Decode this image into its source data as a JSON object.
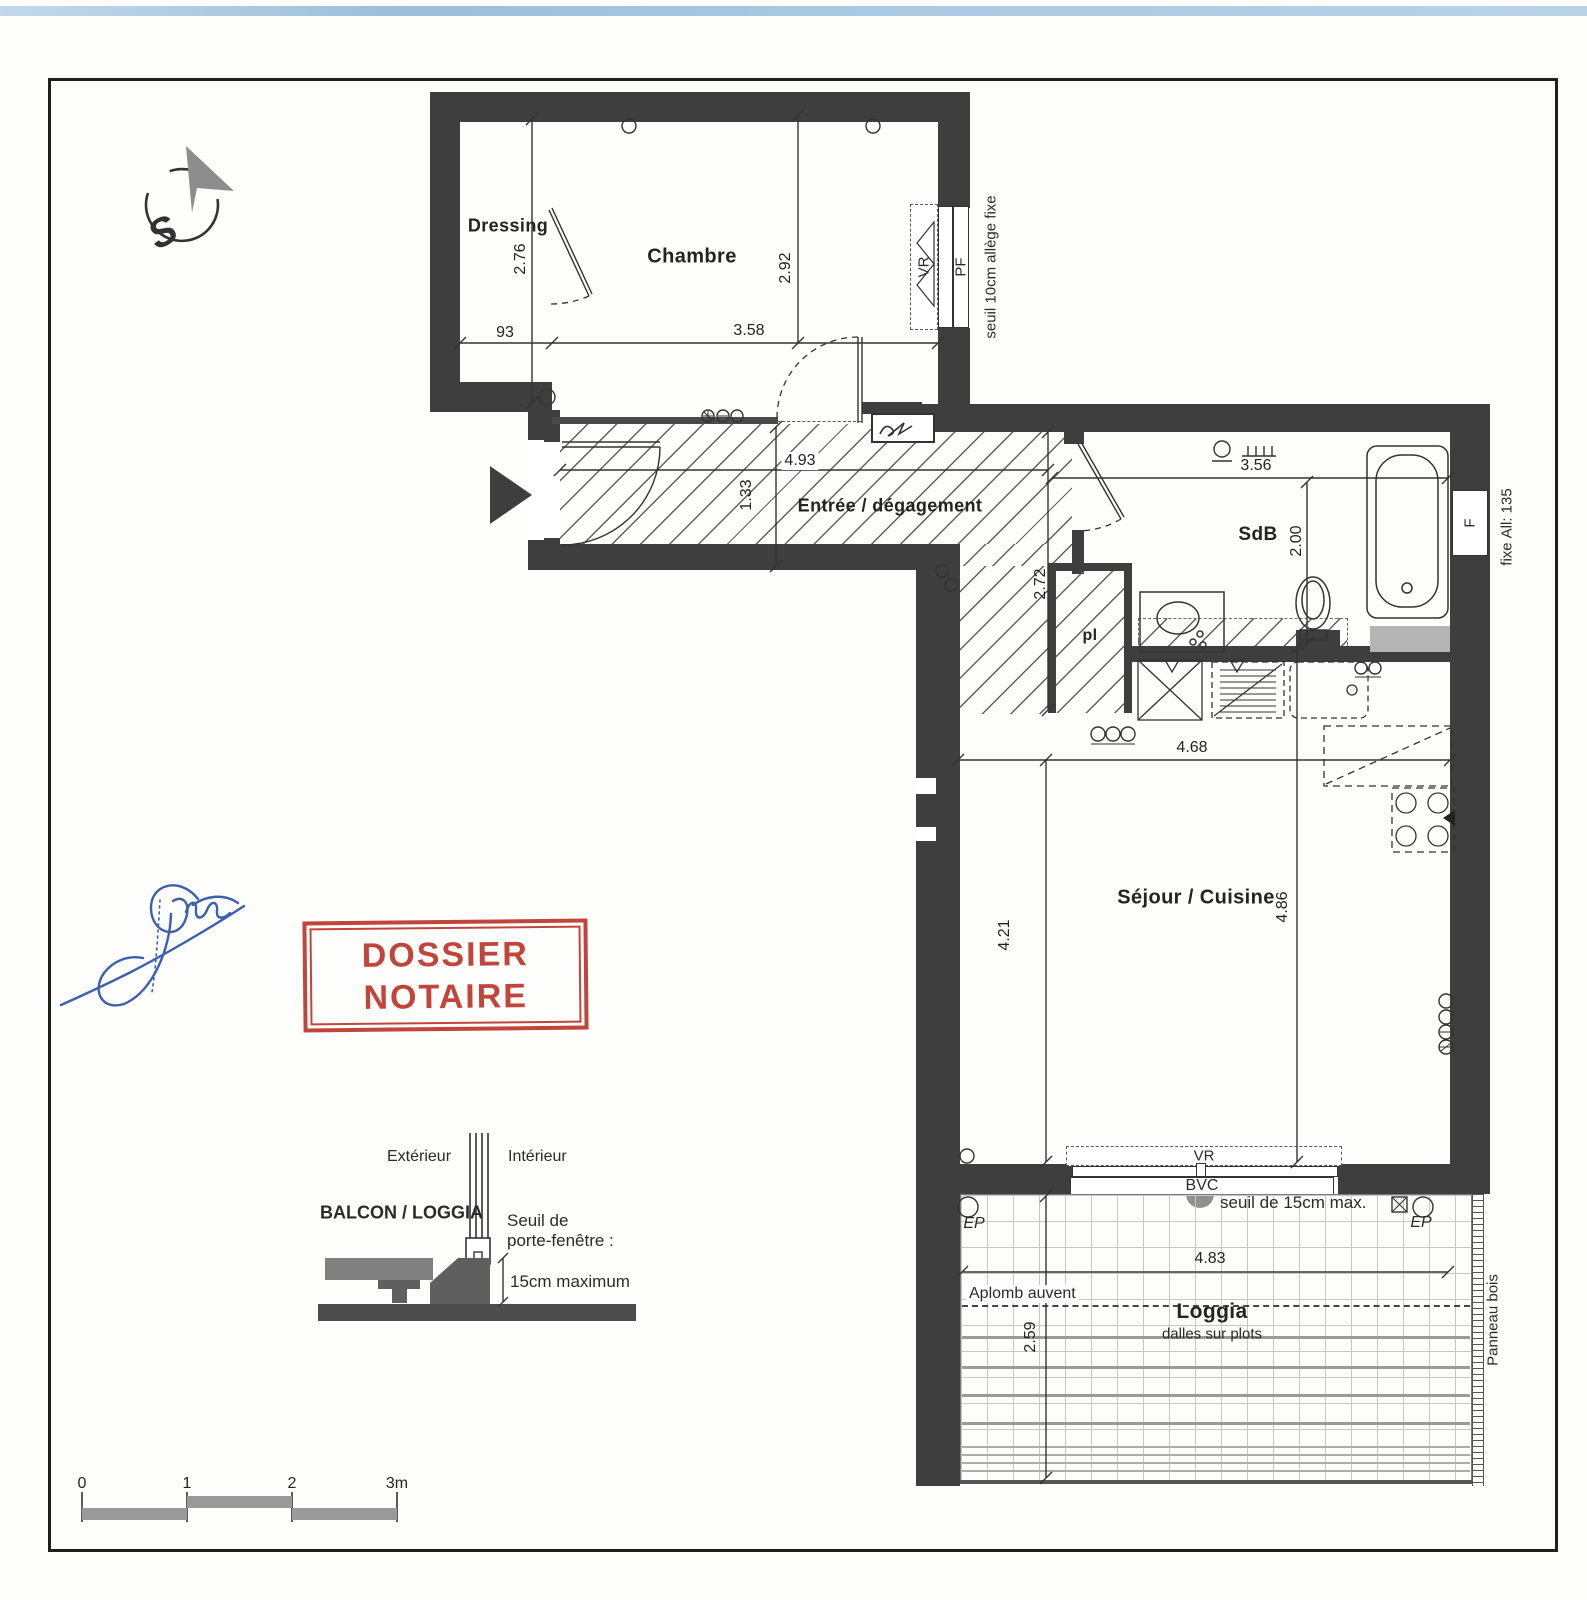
{
  "colors": {
    "wall": "#3e3e3e",
    "stamp_red": "#c2453b",
    "signature_blue": "#3c5fae",
    "top_band_blue": "#a9c8e1"
  },
  "compass": {
    "label": "S"
  },
  "rooms": {
    "dressing": "Dressing",
    "chambre": "Chambre",
    "entree": "Entrée / dégagement",
    "sdb": "SdB",
    "placard": "pl",
    "sejour": "Séjour / Cuisine",
    "loggia": "Loggia",
    "loggia_sub": "dalles sur plots"
  },
  "dims": {
    "dressing_h": "2.76",
    "dressing_w": "93",
    "chambre_h": "2.92",
    "chambre_w": "3.58",
    "entree_w": "4.93",
    "entree_h": "1.33",
    "corridor_h": "2.72",
    "sdb_w": "3.56",
    "sdb_h": "2.00",
    "sejour_w": "4.68",
    "sejour_h_left": "4.21",
    "sejour_h_right": "4.86",
    "loggia_w": "4.83",
    "loggia_h": "2.59"
  },
  "windows": {
    "chambre_vr": "VR",
    "chambre_pf": "PF",
    "chambre_note1": "seuil 10cm",
    "chambre_note2": "allège fixe",
    "sdb_f": "F",
    "sdb_note1": "fixe",
    "sdb_note2": "All: 135",
    "sejour_vr": "VR",
    "sejour_bvc": "BVC",
    "sejour_seuil": "seuil de 15cm max."
  },
  "loggia": {
    "ep_left": "EP",
    "ep_right": "EP",
    "aplomb": "Aplomb auvent",
    "panneau": "Panneau bois"
  },
  "stamp": {
    "line1": "DOSSIER",
    "line2": "NOTAIRE"
  },
  "detail": {
    "exterior": "Extérieur",
    "interior": "Intérieur",
    "title": "BALCON / LOGGIA",
    "seuil_line1": "Seuil de",
    "seuil_line2": "porte-fenêtre :",
    "max": "15cm maximum"
  },
  "scalebar": {
    "t0": "0",
    "t1": "1",
    "t2": "2",
    "t3": "3m"
  }
}
